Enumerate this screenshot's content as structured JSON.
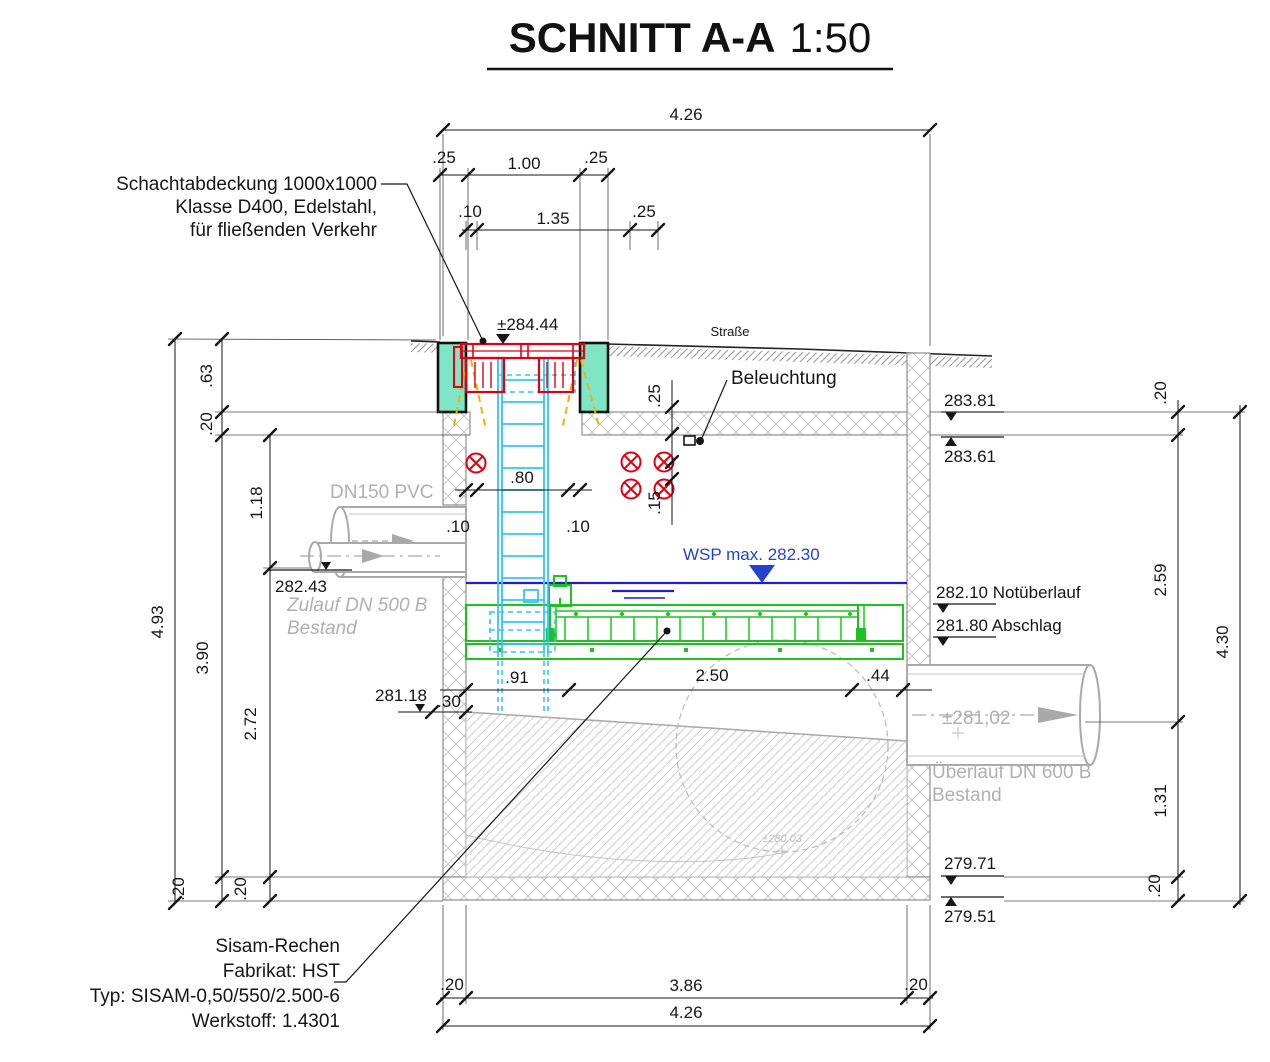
{
  "title": {
    "main": "SCHNITT A-A",
    "scale": "1:50"
  },
  "annotations": {
    "cover": [
      "Schachtabdeckung 1000x1000",
      "Klasse D400, Edelstahl,",
      "für fließenden Verkehr"
    ],
    "lighting": "Beleuchtung",
    "street": "Straße",
    "wsp": "WSP  max. 282.30",
    "dn150": "DN150 PVC",
    "inlet": [
      "Zulauf DN 500 B",
      "Bestand"
    ],
    "outlet": [
      "Überlauf DN 600 B",
      "Bestand"
    ],
    "outlet_axis": "±281,02",
    "invert": "±280.03",
    "rake": [
      "Sisam-Rechen",
      "Fabrikat: HST",
      "Typ: SISAM-0,50/550/2.500-6",
      "Werkstoff: 1.4301"
    ]
  },
  "levels": {
    "top": "±284.44",
    "roof_top": "283.81",
    "roof_bot": "283.61",
    "notueberlauf": "282.10 Notüberlauf",
    "abschlag": "281.80 Abschlag",
    "floor_top": "279.71",
    "floor_bot": "279.51",
    "inlet_invert": "282.43",
    "left_floor": "281.18"
  },
  "dimensions": {
    "top": {
      "total": "4.26",
      "r2": [
        ".25",
        "1.00",
        ".25"
      ],
      "r3": [
        ".10",
        "1.35",
        ".25"
      ]
    },
    "bottom": {
      "r1": [
        ".20",
        "3.86",
        ".20"
      ],
      "total": "4.26"
    },
    "left": {
      "total": "4.93",
      "c2": [
        ".63",
        ".20",
        "3.90",
        ".20"
      ],
      "c3": [
        "1.18",
        "2.72",
        ".20"
      ]
    },
    "right": {
      "c1": [
        ".20",
        "2.59",
        "1.31",
        ".20"
      ],
      "total": "4.30"
    },
    "mid": {
      "ladder": [
        ".10",
        ".80",
        ".10"
      ],
      "c25": ".25",
      "c15": ".15",
      "floor": [
        ".91",
        "2.50",
        ".44"
      ],
      "c30": ".30"
    }
  },
  "colors": {
    "red": "#e10012",
    "teal": "#7fe6c5",
    "cyan": "#35c4f0",
    "green": "#1ec21e",
    "water": "#1f1fc8",
    "wspblue": "#2343cf",
    "lgray": "#b0b0b0",
    "sgray": "#979797",
    "orange": "#f2b100",
    "ink": "#161616"
  }
}
